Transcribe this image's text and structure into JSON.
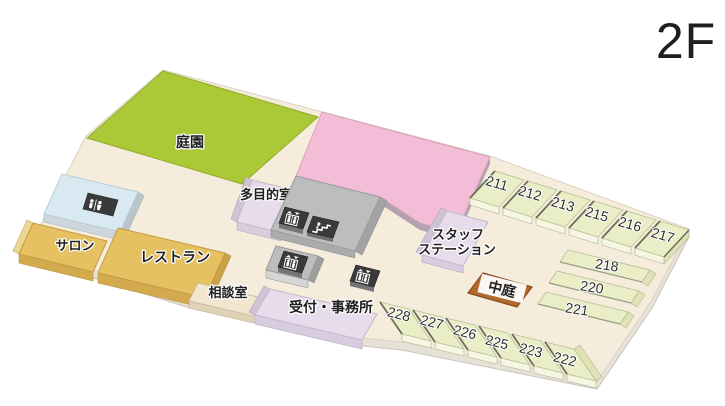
{
  "floor_label": "2F",
  "areas": {
    "garden": {
      "label": "庭園"
    },
    "multipurpose": {
      "label": "多目的室"
    },
    "salon": {
      "label": "サロン"
    },
    "restaurant": {
      "label": "レストラン"
    },
    "consultation": {
      "label": "相談室"
    },
    "reception": {
      "label": "受付・事務所"
    },
    "staff_station": {
      "line1": "スタッフ",
      "line2": "ステーション"
    },
    "courtyard": {
      "label": "中庭"
    }
  },
  "rooms": {
    "top_row": [
      "211",
      "212",
      "213",
      "215",
      "216",
      "217"
    ],
    "right_column": [
      "218",
      "220",
      "221"
    ],
    "bottom_row": [
      "228",
      "227",
      "226",
      "225",
      "223",
      "222"
    ]
  },
  "icons": {
    "restroom": "restroom-icon",
    "elevator": "elevator-icon",
    "stairs": "stairs-icon"
  },
  "colors": {
    "garden": "#abc837",
    "large_room_pink": "#f4bdd7",
    "gold": "#e5c161",
    "lavender": "#e7dcec",
    "gray_core": "#bdbdbd",
    "guest_room": "#eaeec6",
    "floor": "#f6ecdc",
    "courtyard": "#b2692e",
    "light_blue": "#d9e9f1",
    "icon_dark": "#3a3a3a",
    "floor_label_gray": "#ababab",
    "label_text": "#1f1f1f"
  }
}
